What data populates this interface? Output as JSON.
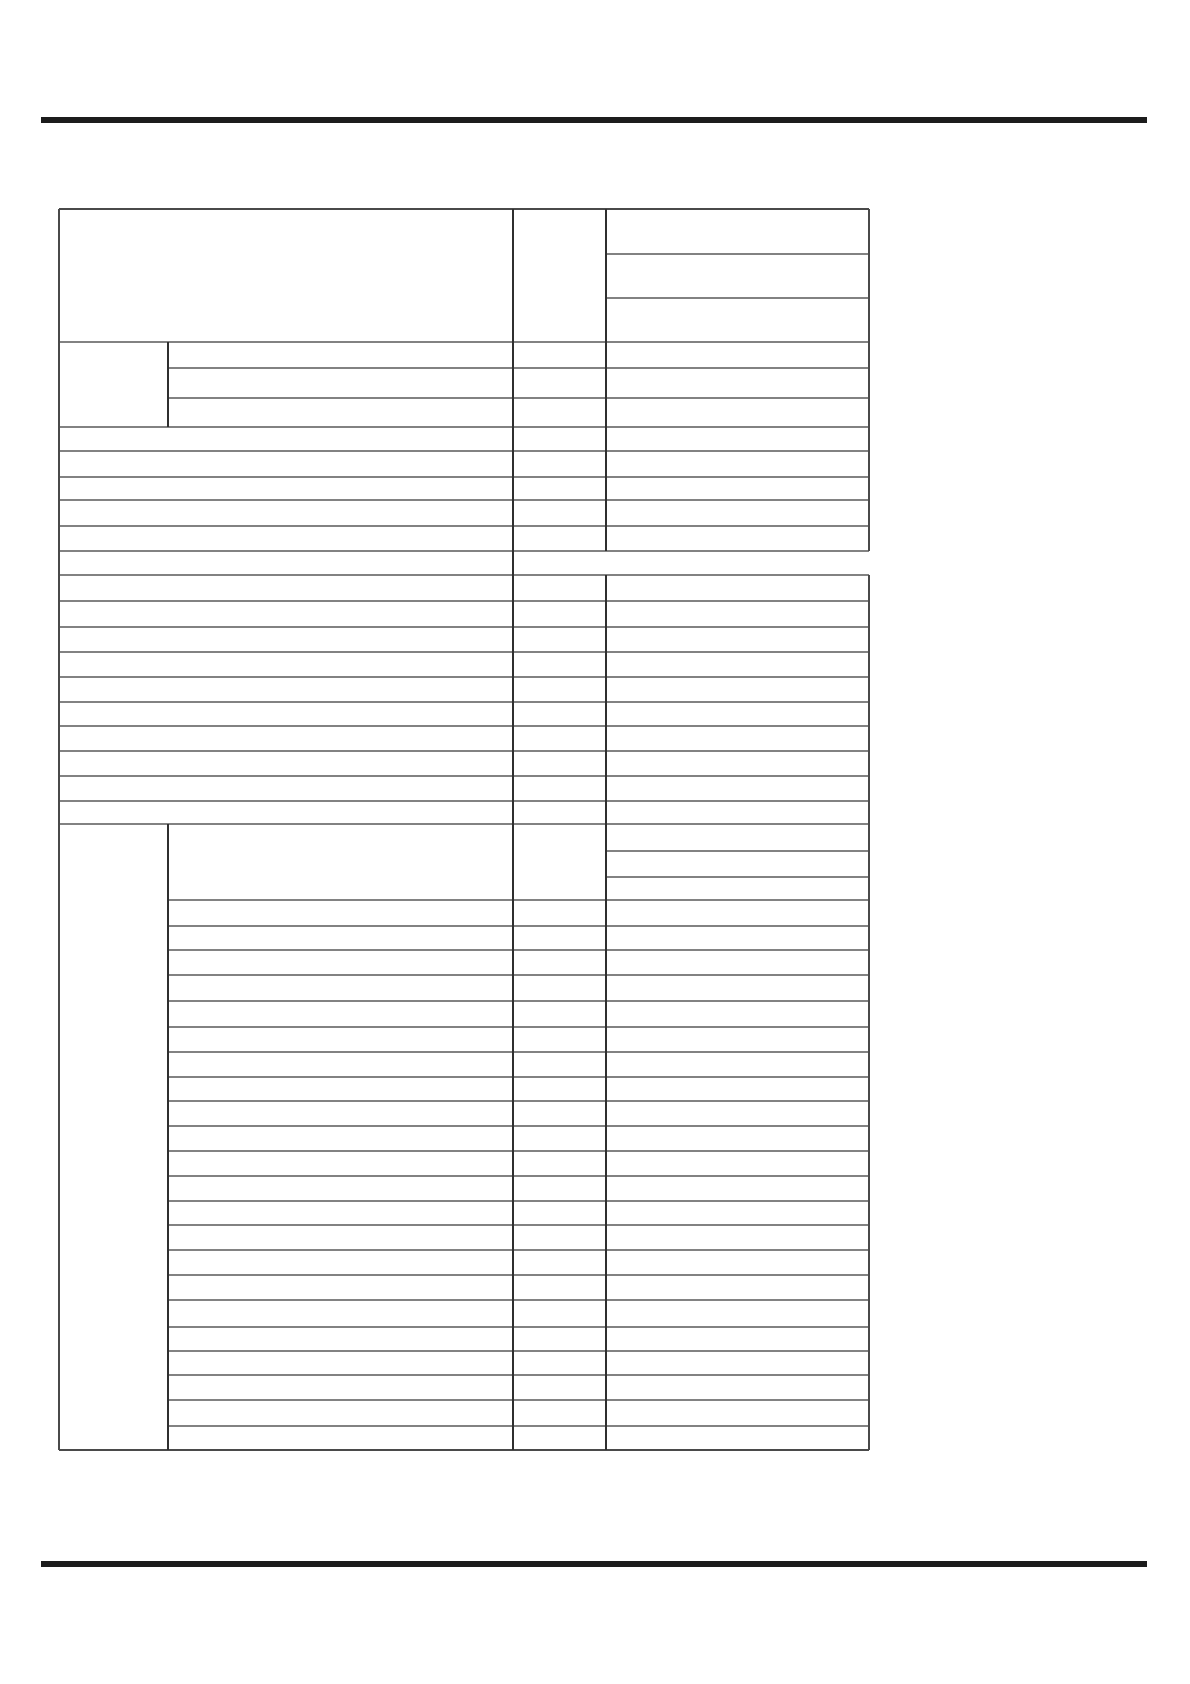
{
  "page": {
    "width": 1190,
    "height": 1684,
    "background": "#ffffff"
  },
  "rules": {
    "color": "#1c1c1c",
    "thickness": 6,
    "top": {
      "x1": 41,
      "x2": 1147,
      "y": 117
    },
    "bottom": {
      "x1": 41,
      "x2": 1147,
      "y": 1561
    }
  },
  "table": {
    "left": 59,
    "right": 869,
    "top": 209,
    "bottom": 1450,
    "columns_x": [
      59,
      168,
      513,
      606,
      869
    ],
    "h_line_color": "#828282",
    "v_line_color": "#2f2f2f",
    "edge_line_color": "#4a4a4a",
    "h_thickness": 2,
    "v_thickness": 2,
    "cells_empty": true,
    "hlines": [
      {
        "y": 209,
        "x1": 59,
        "x2": 869,
        "edge": true
      },
      {
        "y": 254,
        "x1": 606,
        "x2": 869
      },
      {
        "y": 298,
        "x1": 606,
        "x2": 869
      },
      {
        "y": 342,
        "x1": 59,
        "x2": 869
      },
      {
        "y": 368,
        "x1": 168,
        "x2": 869
      },
      {
        "y": 398,
        "x1": 168,
        "x2": 869
      },
      {
        "y": 427,
        "x1": 59,
        "x2": 869
      },
      {
        "y": 451,
        "x1": 59,
        "x2": 869
      },
      {
        "y": 477,
        "x1": 59,
        "x2": 869
      },
      {
        "y": 500,
        "x1": 59,
        "x2": 869
      },
      {
        "y": 526,
        "x1": 59,
        "x2": 869
      },
      {
        "y": 551,
        "x1": 59,
        "x2": 869
      },
      {
        "y": 575,
        "x1": 59,
        "x2": 869
      },
      {
        "y": 601,
        "x1": 59,
        "x2": 869
      },
      {
        "y": 627,
        "x1": 59,
        "x2": 869
      },
      {
        "y": 652,
        "x1": 59,
        "x2": 869
      },
      {
        "y": 677,
        "x1": 59,
        "x2": 869
      },
      {
        "y": 702,
        "x1": 59,
        "x2": 869
      },
      {
        "y": 726,
        "x1": 59,
        "x2": 869
      },
      {
        "y": 751,
        "x1": 59,
        "x2": 869
      },
      {
        "y": 776,
        "x1": 59,
        "x2": 869
      },
      {
        "y": 801,
        "x1": 59,
        "x2": 869
      },
      {
        "y": 824,
        "x1": 59,
        "x2": 869
      },
      {
        "y": 851,
        "x1": 606,
        "x2": 869
      },
      {
        "y": 877,
        "x1": 606,
        "x2": 869
      },
      {
        "y": 900,
        "x1": 168,
        "x2": 869
      },
      {
        "y": 926,
        "x1": 168,
        "x2": 869
      },
      {
        "y": 950,
        "x1": 168,
        "x2": 869
      },
      {
        "y": 975,
        "x1": 168,
        "x2": 869
      },
      {
        "y": 1001,
        "x1": 168,
        "x2": 869
      },
      {
        "y": 1027,
        "x1": 168,
        "x2": 869
      },
      {
        "y": 1052,
        "x1": 168,
        "x2": 869
      },
      {
        "y": 1077,
        "x1": 168,
        "x2": 869
      },
      {
        "y": 1101,
        "x1": 168,
        "x2": 869
      },
      {
        "y": 1126,
        "x1": 168,
        "x2": 869
      },
      {
        "y": 1151,
        "x1": 168,
        "x2": 869
      },
      {
        "y": 1176,
        "x1": 168,
        "x2": 869
      },
      {
        "y": 1201,
        "x1": 168,
        "x2": 869
      },
      {
        "y": 1225,
        "x1": 168,
        "x2": 869
      },
      {
        "y": 1250,
        "x1": 168,
        "x2": 869
      },
      {
        "y": 1275,
        "x1": 168,
        "x2": 869
      },
      {
        "y": 1300,
        "x1": 168,
        "x2": 869
      },
      {
        "y": 1327,
        "x1": 168,
        "x2": 869
      },
      {
        "y": 1351,
        "x1": 168,
        "x2": 869
      },
      {
        "y": 1375,
        "x1": 168,
        "x2": 869
      },
      {
        "y": 1400,
        "x1": 168,
        "x2": 869
      },
      {
        "y": 1426,
        "x1": 168,
        "x2": 869
      },
      {
        "y": 1450,
        "x1": 59,
        "x2": 869,
        "edge": true
      }
    ],
    "vlines": [
      {
        "x": 59,
        "y1": 209,
        "y2": 1450,
        "edge": true
      },
      {
        "x": 168,
        "y1": 342,
        "y2": 427
      },
      {
        "x": 168,
        "y1": 824,
        "y2": 1450
      },
      {
        "x": 513,
        "y1": 209,
        "y2": 1450
      },
      {
        "x": 606,
        "y1": 209,
        "y2": 551
      },
      {
        "x": 606,
        "y1": 575,
        "y2": 1450
      },
      {
        "x": 869,
        "y1": 209,
        "y2": 551,
        "edge": true
      },
      {
        "x": 869,
        "y1": 575,
        "y2": 1450,
        "edge": true
      }
    ]
  }
}
